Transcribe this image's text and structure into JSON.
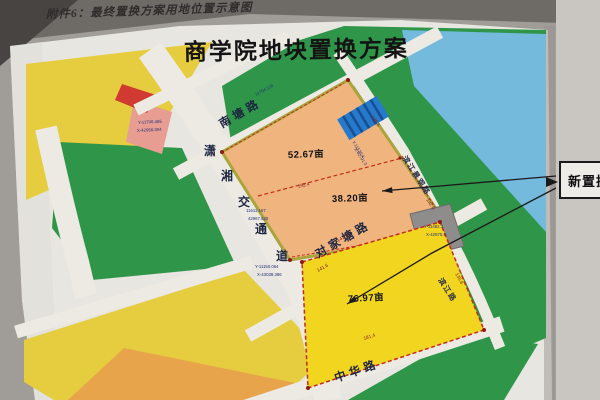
{
  "photo": {
    "caption": "附件6：最终置换方案用地位置示意图"
  },
  "map": {
    "title": "商学院地块置换方案",
    "callout": {
      "label": "新置换地块"
    },
    "roads": {
      "nantang": "南塘路",
      "xiaoxiang_chars": [
        "潇",
        "湘",
        "交",
        "通",
        "道"
      ],
      "duijiatang": "对家塘路",
      "zhonghua": "中华路",
      "binjiang_upper": "滨江景观路",
      "binjiang_lower": "滨江路"
    },
    "parcels": {
      "p1": {
        "area": "52.67亩"
      },
      "p2": {
        "area": "38.20亩"
      },
      "p3": {
        "area": "76.97亩"
      }
    },
    "coords": {
      "pink": [
        "Y-11706.465",
        "X-42958.394"
      ],
      "mid": [
        "11611.167",
        "42967.625"
      ],
      "low": [
        "Y-11150.064",
        "X-43038.386"
      ],
      "gray": [
        "Y-11482.3",
        "X-42875.5"
      ],
      "blue_block": [
        "Y-11520.4",
        "X-42791.3"
      ],
      "top_green": "11704.128"
    },
    "dims": [
      "192.4",
      "135.6",
      "142.0",
      "141.4",
      "141.6",
      "135.8",
      "181.4"
    ],
    "colors": {
      "paper": "#e8e6e0",
      "photo_bg": "#a8a5a0",
      "green": "#2f9649",
      "yellow": "#e5cd3f",
      "bright_yellow": "#f2d51f",
      "orange_parcel": "#f0b57e",
      "orange_block": "#e8a44a",
      "river_blue": "#74badc",
      "red_block": "#d03a30",
      "pink_block": "#e79d92",
      "hatch_blue": "#2679cb",
      "gray_block": "#8f8c8c",
      "dash_red": "#c32b1e",
      "olive_edge": "#a9a43c",
      "road": "#eceae3"
    }
  }
}
